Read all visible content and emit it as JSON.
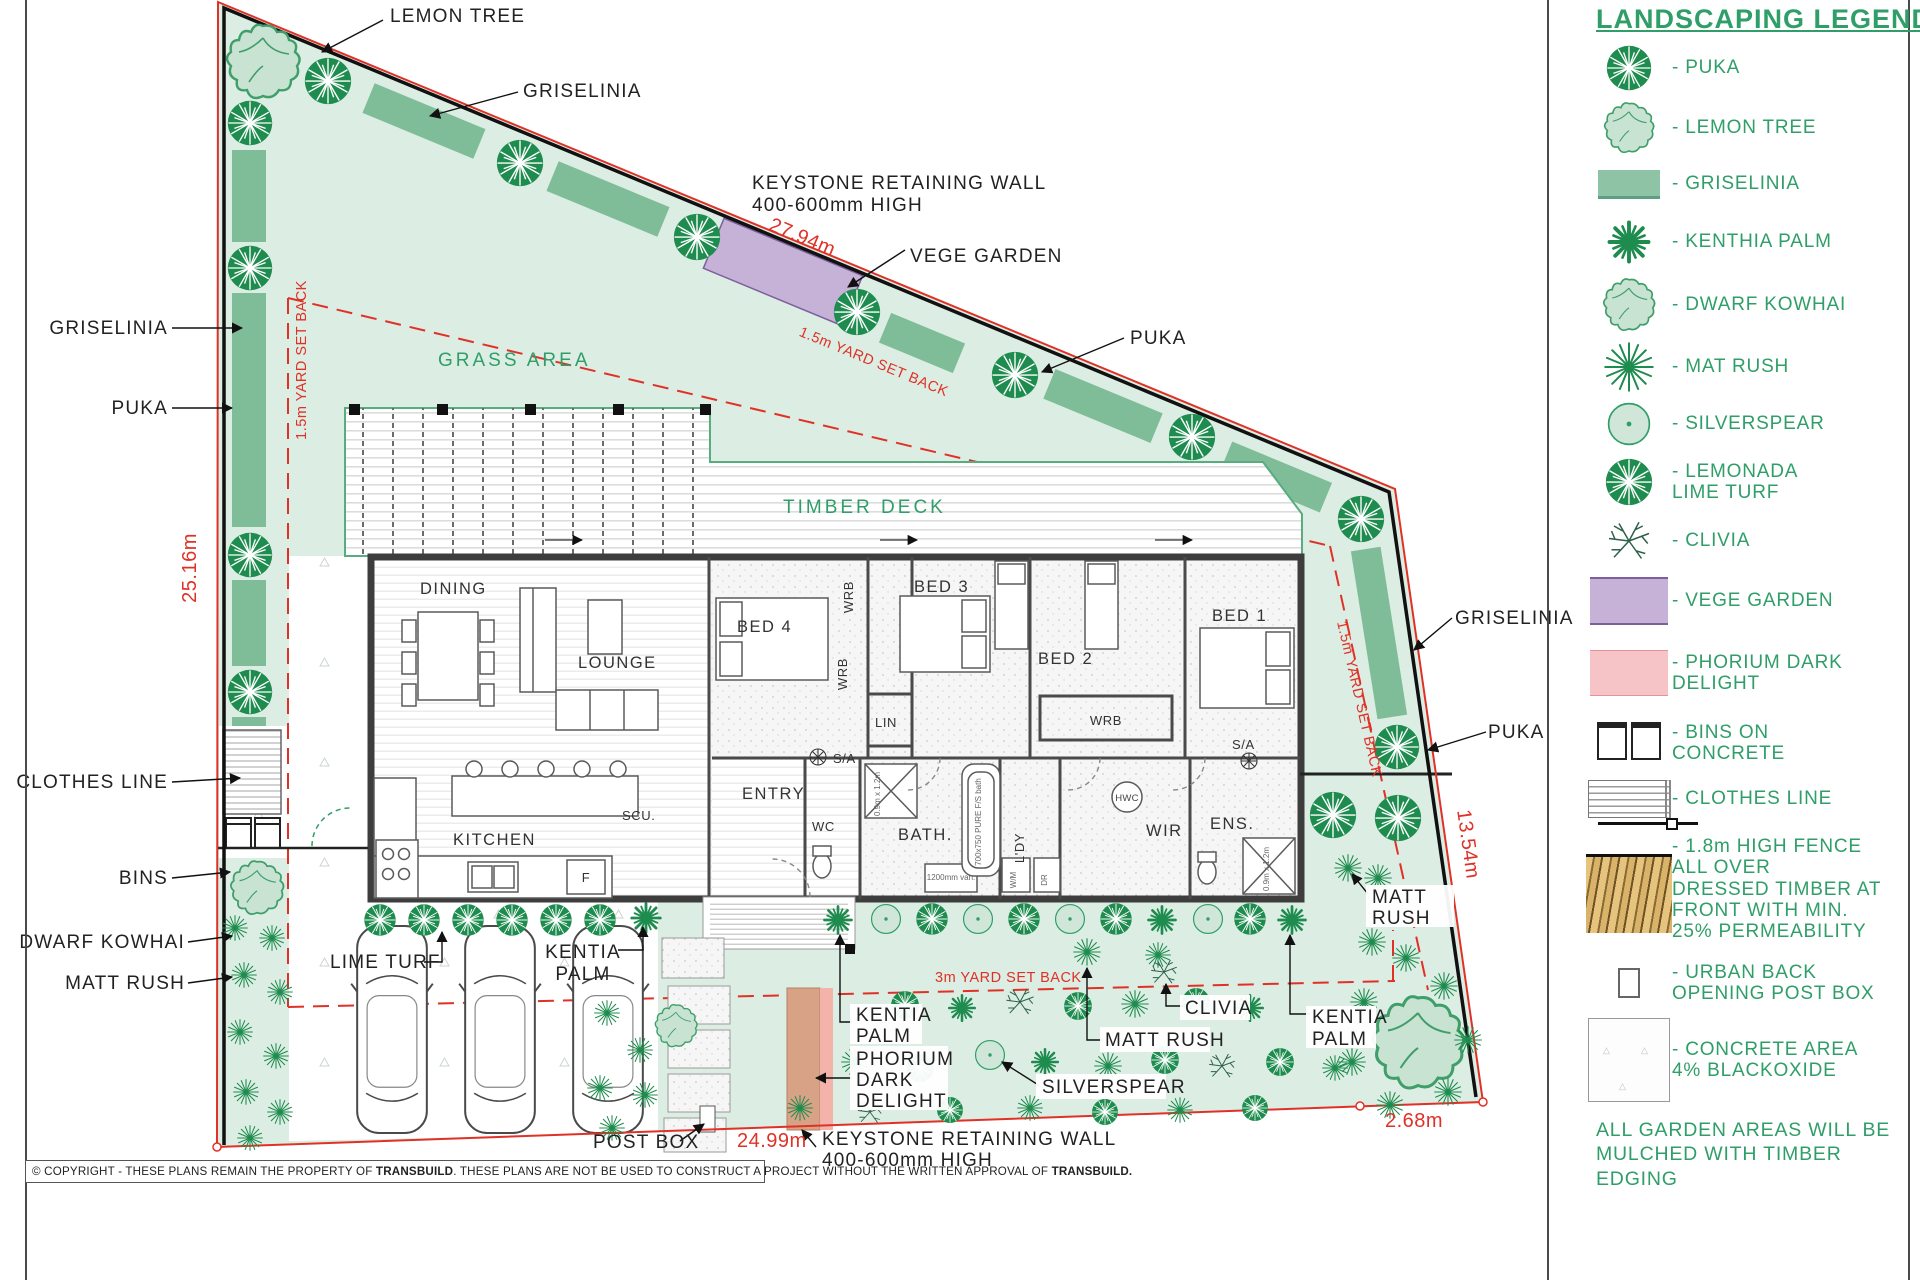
{
  "legend": {
    "title": "LANDSCAPING LEGEND",
    "items": [
      {
        "icon": "puka",
        "label": "- PUKA"
      },
      {
        "icon": "lemon-tree",
        "label": "- LEMON TREE"
      },
      {
        "icon": "griselinia",
        "label": "- GRISELINIA"
      },
      {
        "icon": "kenthia-palm",
        "label": "- KENTHIA PALM"
      },
      {
        "icon": "dwarf-kowhai",
        "label": "- DWARF KOWHAI"
      },
      {
        "icon": "mat-rush",
        "label": "- MAT RUSH"
      },
      {
        "icon": "silverspear",
        "label": "- SILVERSPEAR"
      },
      {
        "icon": "lemonada-lime-turf",
        "label": "- LEMONADA\nLIME TURF"
      },
      {
        "icon": "clivia",
        "label": "- CLIVIA"
      },
      {
        "icon": "vege-garden",
        "label": "- VEGE GARDEN"
      },
      {
        "icon": "phorium-dark-delight",
        "label": "- PHORIUM DARK\nDELIGHT"
      },
      {
        "icon": "bins-on-concrete",
        "label": "- BINS ON\nCONCRETE"
      },
      {
        "icon": "clothes-line",
        "label": "- CLOTHES LINE"
      },
      {
        "icon": "timber-fence",
        "label": "- 1.8m HIGH FENCE\nALL OVER\nDRESSED TIMBER AT\nFRONT WITH MIN.\n25% PERMEABILITY"
      },
      {
        "icon": "post-box",
        "label": "- URBAN BACK\nOPENING POST BOX"
      },
      {
        "icon": "concrete-area",
        "label": "- CONCRETE AREA\n4% BLACKOXIDE"
      }
    ],
    "footer": "ALL GARDEN AREAS WILL BE\nMULCHED WITH TIMBER EDGING"
  },
  "plan": {
    "areas": {
      "grass": "GRASS AREA",
      "deck": "TIMBER DECK"
    },
    "callouts": {
      "lemon_tree": "LEMON TREE",
      "griselinia_top": "GRISELINIA",
      "keystone_line1": "KEYSTONE RETAINING WALL",
      "keystone_line2": "400-600mm HIGH",
      "vege_garden": "VEGE GARDEN",
      "puka_top": "PUKA",
      "griselinia_left": "GRISELINIA",
      "puka_left": "PUKA",
      "clothes_line": "CLOTHES LINE",
      "bins": "BINS",
      "dwarf_kowhai": "DWARF KOWHAI",
      "matt_rush_left": "MATT RUSH",
      "lime_turf": "LIME TURF",
      "kentia1": "KENTIA",
      "kentia2": "PALM",
      "post_box": "POST BOX",
      "phorium1": "PHORIUM",
      "phorium2": "DARK",
      "phorium3": "DELIGHT",
      "silverspear": "SILVERSPEAR",
      "matt_rush_center": "MATT RUSH",
      "clivia": "CLIVIA",
      "matt1": "MATT",
      "matt2": "RUSH",
      "griselinia_right": "GRISELINIA",
      "puka_right": "PUKA"
    },
    "rooms": {
      "dining": "DINING",
      "lounge": "LOUNGE",
      "bed4": "BED 4",
      "bed3": "BED 3",
      "bed2": "BED 2",
      "bed1": "BED 1",
      "kitchen": "KITCHEN",
      "scu": "SCU.",
      "entry": "ENTRY",
      "wc": "WC",
      "bath": "BATH.",
      "ldy": "L'DY",
      "wir": "WIR",
      "ens": "ENS.",
      "wrb": "WRB",
      "lin": "LIN",
      "sa": "S/A",
      "hwc": "HWC",
      "fridge": "F",
      "wm": "W/M",
      "dr": "DR"
    },
    "notes": {
      "shower": "0.9m x 1.2m",
      "bath_tub": "700x750 PURE F/S bath",
      "vanity": "1200mm van."
    },
    "dimensions": {
      "left": "25.16m",
      "top": "27.94m",
      "right": "13.54m",
      "bottom": "24.99m",
      "bottom_right": "2.68m"
    },
    "setbacks": {
      "side": "1.5m YARD SET BACK",
      "front": "3m YARD SET BACK"
    }
  },
  "copyright": {
    "p1": "© COPYRIGHT - THESE PLANS REMAIN THE PROPERTY OF ",
    "p2": "TRANSBUILD",
    "p3": ". THESE PLANS ARE NOT BE USED TO CONSTRUCT A PROJECT WITHOUT THE WRITTEN APPROVAL OF ",
    "p4": "TRANSBUILD."
  },
  "colors": {
    "legend_green": "#2f9e68",
    "boundary_red": "#e03127",
    "grass": "#dcede3",
    "hedge": "#7fbd99",
    "dark_tree": "#1e8c4e",
    "light_tree": "#c8e3d2",
    "vege_purple": "#c7b2d7",
    "phorium_pink": "#f6c3c6",
    "wall_gray": "#3d3d3d"
  }
}
